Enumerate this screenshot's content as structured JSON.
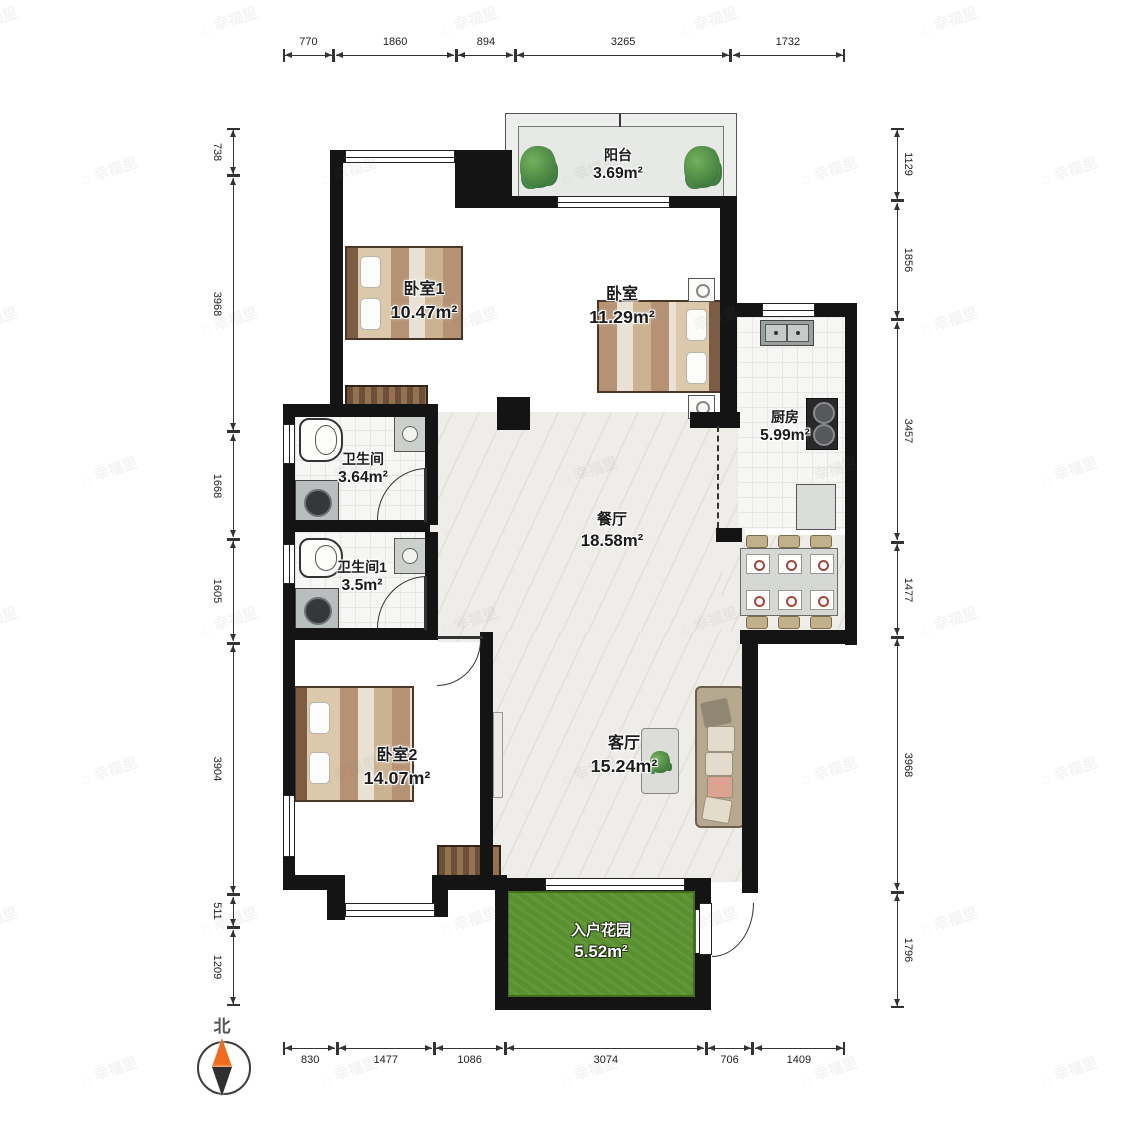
{
  "watermark": {
    "text": "幸福里",
    "icon": "house-icon"
  },
  "compass": {
    "label": "北"
  },
  "rooms": {
    "balcony": {
      "name": "阳台",
      "area": "3.69m²"
    },
    "bedroom1": {
      "name": "卧室1",
      "area": "10.47m²"
    },
    "bedroom": {
      "name": "卧室",
      "area": "11.29m²"
    },
    "kitchen": {
      "name": "厨房",
      "area": "5.99m²"
    },
    "bathroom": {
      "name": "卫生间",
      "area": "3.64m²"
    },
    "dining": {
      "name": "餐厅",
      "area": "18.58m²"
    },
    "bathroom1": {
      "name": "卫生间1",
      "area": "3.5m²"
    },
    "bedroom2": {
      "name": "卧室2",
      "area": "14.07m²"
    },
    "living": {
      "name": "客厅",
      "area": "15.24m²"
    },
    "garden": {
      "name": "入户花园",
      "area": "5.52m²"
    }
  },
  "dimensions": {
    "top": [
      770,
      1860,
      894,
      3265,
      1732
    ],
    "bottom": [
      830,
      1477,
      1086,
      3074,
      706,
      1409
    ],
    "left": [
      738,
      3968,
      1668,
      1605,
      3904,
      511,
      1209
    ],
    "right": [
      1129,
      1856,
      3457,
      1477,
      3968,
      1796
    ]
  },
  "colors": {
    "wall": "#141414",
    "wood_floor": "#f3cd8f",
    "marble_floor": "#efedea",
    "tile_floor": "#f6f7f4",
    "garden_green": "#5a9130",
    "compass_north": "#f26b1d"
  }
}
